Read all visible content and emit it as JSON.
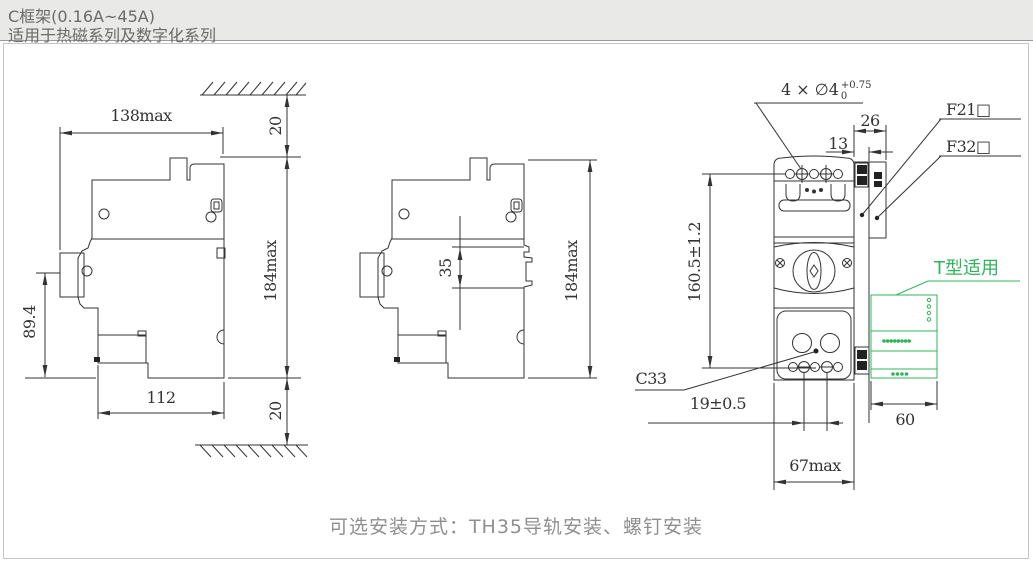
{
  "header": {
    "title": "C框架(0.16A~45A)",
    "subtitle": "适用于热磁系列及数字化系列"
  },
  "caption": "可选安装方式：TH35导轨安装、螺钉安装",
  "colors": {
    "line": "#333333",
    "accent_green": "#2fb45a",
    "header_bg": "#e9e9e7",
    "header_text": "#6a6a6a",
    "caption_text": "#8f8f8f"
  },
  "left_view": {
    "width": "138max",
    "top_clearance": "20",
    "height": "184max",
    "lever_height": "89.4",
    "base_width": "112",
    "bottom_clearance": "20"
  },
  "middle_view": {
    "rail_slot": "35",
    "height": "184max"
  },
  "front_view": {
    "mounting_holes": "4 × ∅4",
    "hole_tol_upper": "+0.75",
    "hole_tol_lower": "0",
    "side_module_depth": "26",
    "rail_depth": "13",
    "mounting_height": "160.5±1.2",
    "terminal_pitch": "19±0.5",
    "accessory_width": "60",
    "width": "67max",
    "f21": "F21□",
    "f32": "F32□",
    "c33": "C33",
    "t_type": "T型适用"
  }
}
